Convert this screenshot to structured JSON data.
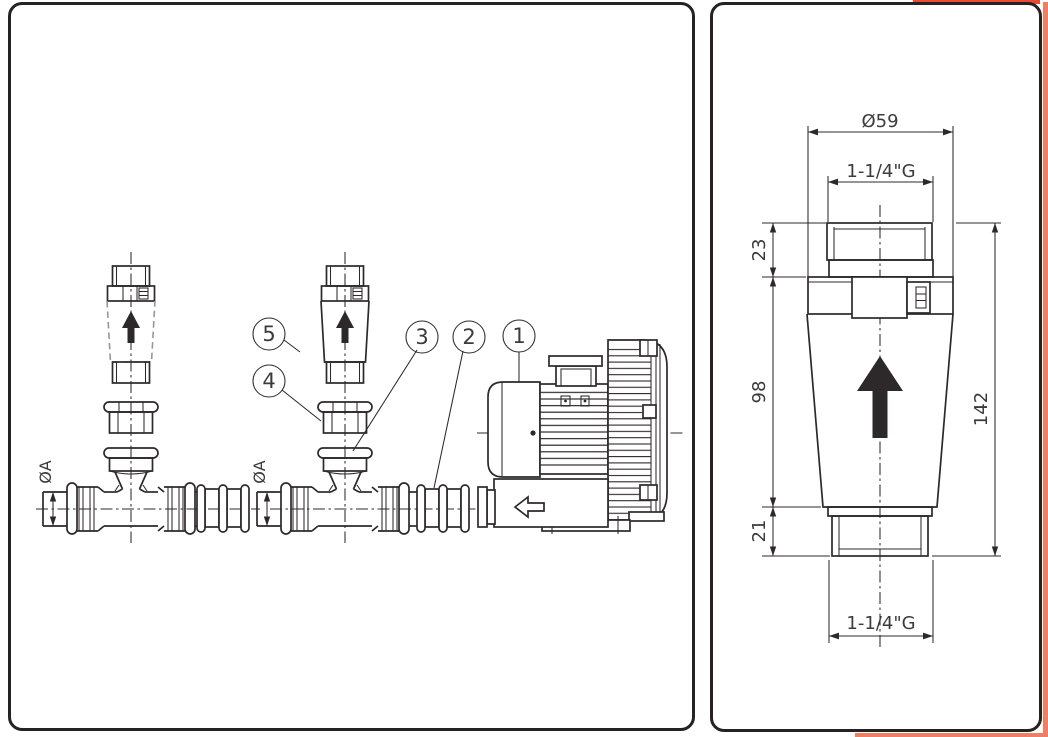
{
  "page": {
    "background": "#ffffff"
  },
  "colors": {
    "line": "#2d292a",
    "text": "#3b3b3c",
    "accent_red": "#e84b31",
    "accent_salmon": "#ec8066"
  },
  "left_panel": {
    "callouts": [
      {
        "id": "1"
      },
      {
        "id": "2"
      },
      {
        "id": "3"
      },
      {
        "id": "4"
      },
      {
        "id": "5"
      }
    ],
    "dims": {
      "pipe_diameter_left": "ØA",
      "pipe_diameter_mid": "ØA"
    }
  },
  "right_panel": {
    "dims": {
      "outer_diameter": "Ø59",
      "top_thread": "1-1/4\"G",
      "top_section_height": "23",
      "body_height": "98",
      "bottom_section_height": "21",
      "total_height": "142",
      "bottom_thread": "1-1/4\"G"
    }
  }
}
